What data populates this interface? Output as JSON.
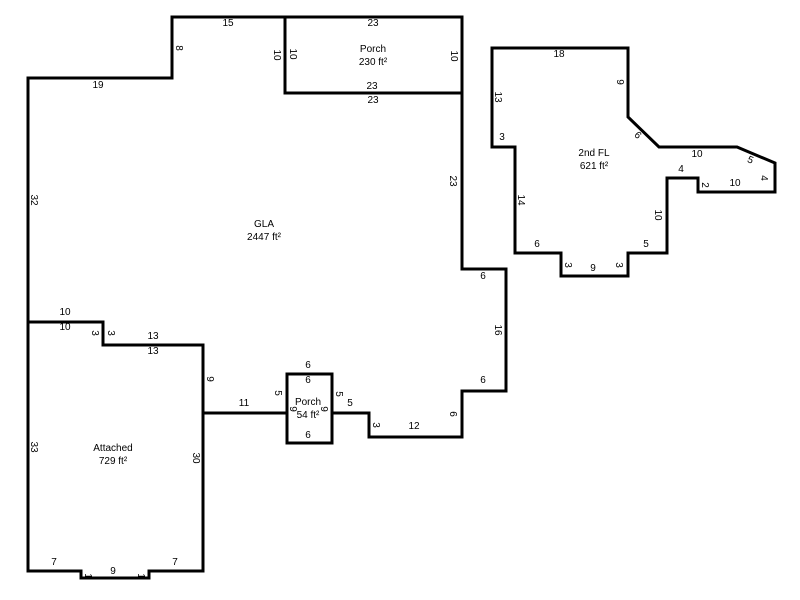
{
  "sketch": {
    "canvas": {
      "width": 800,
      "height": 600,
      "background_color": "#ffffff",
      "line_color": "#000000",
      "line_width": 3,
      "text_color": "#000000"
    },
    "areas": [
      {
        "id": "gla",
        "title": "GLA",
        "area_text": "2447 ft²",
        "title_pos": [
          264,
          231
        ],
        "points": [
          [
            28,
            78
          ],
          [
            172,
            78
          ],
          [
            172,
            17
          ],
          [
            285,
            17
          ],
          [
            285,
            93
          ],
          [
            462,
            93
          ],
          [
            462,
            269
          ],
          [
            506,
            269
          ],
          [
            506,
            391
          ],
          [
            462,
            391
          ],
          [
            462,
            437
          ],
          [
            369,
            437
          ],
          [
            369,
            413
          ],
          [
            332,
            413
          ],
          [
            332,
            374
          ],
          [
            287,
            374
          ],
          [
            287,
            413
          ],
          [
            203,
            413
          ],
          [
            203,
            345
          ],
          [
            103,
            345
          ],
          [
            103,
            322
          ],
          [
            28,
            322
          ]
        ],
        "dims": [
          {
            "t": "19",
            "x": 98,
            "y": 86,
            "r": 0
          },
          {
            "t": "8",
            "x": 178,
            "y": 48,
            "r": 90
          },
          {
            "t": "15",
            "x": 228,
            "y": 24,
            "r": 0
          },
          {
            "t": "10",
            "x": 276,
            "y": 55,
            "r": 90
          },
          {
            "t": "23",
            "x": 373,
            "y": 101,
            "r": 0
          },
          {
            "t": "23",
            "x": 452,
            "y": 181,
            "r": 90
          },
          {
            "t": "6",
            "x": 483,
            "y": 277,
            "r": 0
          },
          {
            "t": "16",
            "x": 497,
            "y": 330,
            "r": 90
          },
          {
            "t": "6",
            "x": 483,
            "y": 381,
            "r": 0
          },
          {
            "t": "6",
            "x": 452,
            "y": 414,
            "r": 90
          },
          {
            "t": "12",
            "x": 414,
            "y": 427,
            "r": 0
          },
          {
            "t": "3",
            "x": 375,
            "y": 425,
            "r": 90
          },
          {
            "t": "5",
            "x": 350,
            "y": 404,
            "r": 0
          },
          {
            "t": "5",
            "x": 338,
            "y": 394,
            "r": 90
          },
          {
            "t": "6",
            "x": 308,
            "y": 366,
            "r": 0
          },
          {
            "t": "5",
            "x": 277,
            "y": 393,
            "r": 90
          },
          {
            "t": "11",
            "x": 244,
            "y": 404,
            "r": 0
          },
          {
            "t": "9",
            "x": 209,
            "y": 379,
            "r": 90
          },
          {
            "t": "13",
            "x": 153,
            "y": 337,
            "r": 0
          },
          {
            "t": "3",
            "x": 110,
            "y": 333,
            "r": 90
          },
          {
            "t": "10",
            "x": 65,
            "y": 313,
            "r": 0
          },
          {
            "t": "32",
            "x": 33,
            "y": 200,
            "r": 90
          }
        ]
      },
      {
        "id": "porch-top",
        "title": "Porch",
        "area_text": "230 ft²",
        "title_pos": [
          373,
          56
        ],
        "points": [
          [
            285,
            17
          ],
          [
            462,
            17
          ],
          [
            462,
            93
          ],
          [
            285,
            93
          ]
        ],
        "dims": [
          {
            "t": "23",
            "x": 373,
            "y": 24,
            "r": 0
          },
          {
            "t": "10",
            "x": 292,
            "y": 54,
            "r": 90
          },
          {
            "t": "10",
            "x": 453,
            "y": 56,
            "r": 90
          },
          {
            "t": "23",
            "x": 372,
            "y": 87,
            "r": 0
          }
        ]
      },
      {
        "id": "second-fl",
        "title": "2nd FL",
        "area_text": "621 ft²",
        "title_pos": [
          594,
          160
        ],
        "points": [
          [
            492,
            48
          ],
          [
            628,
            48
          ],
          [
            628,
            117
          ],
          [
            659,
            147
          ],
          [
            737,
            147
          ],
          [
            775,
            163
          ],
          [
            775,
            192
          ],
          [
            698,
            192
          ],
          [
            698,
            178
          ],
          [
            667,
            178
          ],
          [
            667,
            253
          ],
          [
            628,
            253
          ],
          [
            628,
            276
          ],
          [
            561,
            276
          ],
          [
            561,
            253
          ],
          [
            515,
            253
          ],
          [
            515,
            147
          ],
          [
            492,
            147
          ]
        ],
        "dims": [
          {
            "t": "18",
            "x": 559,
            "y": 55,
            "r": 0
          },
          {
            "t": "9",
            "x": 619,
            "y": 82,
            "r": 90
          },
          {
            "t": "6",
            "x": 637,
            "y": 136,
            "r": 44
          },
          {
            "t": "10",
            "x": 697,
            "y": 155,
            "r": 0
          },
          {
            "t": "5",
            "x": 750,
            "y": 161,
            "r": 23
          },
          {
            "t": "4",
            "x": 763,
            "y": 178,
            "r": 90
          },
          {
            "t": "10",
            "x": 735,
            "y": 184,
            "r": 0
          },
          {
            "t": "2",
            "x": 704,
            "y": 185,
            "r": 90
          },
          {
            "t": "4",
            "x": 681,
            "y": 170,
            "r": 0
          },
          {
            "t": "10",
            "x": 657,
            "y": 215,
            "r": 90
          },
          {
            "t": "5",
            "x": 646,
            "y": 245,
            "r": 0
          },
          {
            "t": "3",
            "x": 618,
            "y": 265,
            "r": 90
          },
          {
            "t": "9",
            "x": 593,
            "y": 269,
            "r": 0
          },
          {
            "t": "3",
            "x": 567,
            "y": 265,
            "r": 90
          },
          {
            "t": "6",
            "x": 537,
            "y": 245,
            "r": 0
          },
          {
            "t": "14",
            "x": 520,
            "y": 200,
            "r": 90
          },
          {
            "t": "3",
            "x": 502,
            "y": 138,
            "r": 0
          },
          {
            "t": "13",
            "x": 497,
            "y": 97,
            "r": 90
          }
        ]
      },
      {
        "id": "porch-small",
        "title": "Porch",
        "area_text": "54 ft²",
        "title_pos": [
          308,
          409
        ],
        "points": [
          [
            287,
            374
          ],
          [
            332,
            374
          ],
          [
            332,
            443
          ],
          [
            287,
            443
          ]
        ],
        "dims": [
          {
            "t": "6",
            "x": 308,
            "y": 381,
            "r": 0
          },
          {
            "t": "9",
            "x": 323,
            "y": 409,
            "r": 90
          },
          {
            "t": "6",
            "x": 308,
            "y": 436,
            "r": 0
          },
          {
            "t": "9",
            "x": 292,
            "y": 409,
            "r": 90
          }
        ]
      },
      {
        "id": "attached",
        "title": "Attached",
        "area_text": "729 ft²",
        "title_pos": [
          113,
          455
        ],
        "points": [
          [
            28,
            322
          ],
          [
            103,
            322
          ],
          [
            103,
            345
          ],
          [
            203,
            345
          ],
          [
            203,
            571
          ],
          [
            149,
            571
          ],
          [
            149,
            578
          ],
          [
            81,
            578
          ],
          [
            81,
            571
          ],
          [
            28,
            571
          ]
        ],
        "dims": [
          {
            "t": "10",
            "x": 65,
            "y": 328,
            "r": 0
          },
          {
            "t": "3",
            "x": 94,
            "y": 333,
            "r": 90
          },
          {
            "t": "13",
            "x": 153,
            "y": 352,
            "r": 0
          },
          {
            "t": "30",
            "x": 195,
            "y": 458,
            "r": 90
          },
          {
            "t": "7",
            "x": 175,
            "y": 563,
            "r": 0
          },
          {
            "t": "1",
            "x": 140,
            "y": 576,
            "r": 90
          },
          {
            "t": "9",
            "x": 113,
            "y": 572,
            "r": 0
          },
          {
            "t": "1",
            "x": 87,
            "y": 576,
            "r": 90
          },
          {
            "t": "7",
            "x": 54,
            "y": 563,
            "r": 0
          },
          {
            "t": "33",
            "x": 33,
            "y": 447,
            "r": 90
          }
        ]
      }
    ]
  }
}
